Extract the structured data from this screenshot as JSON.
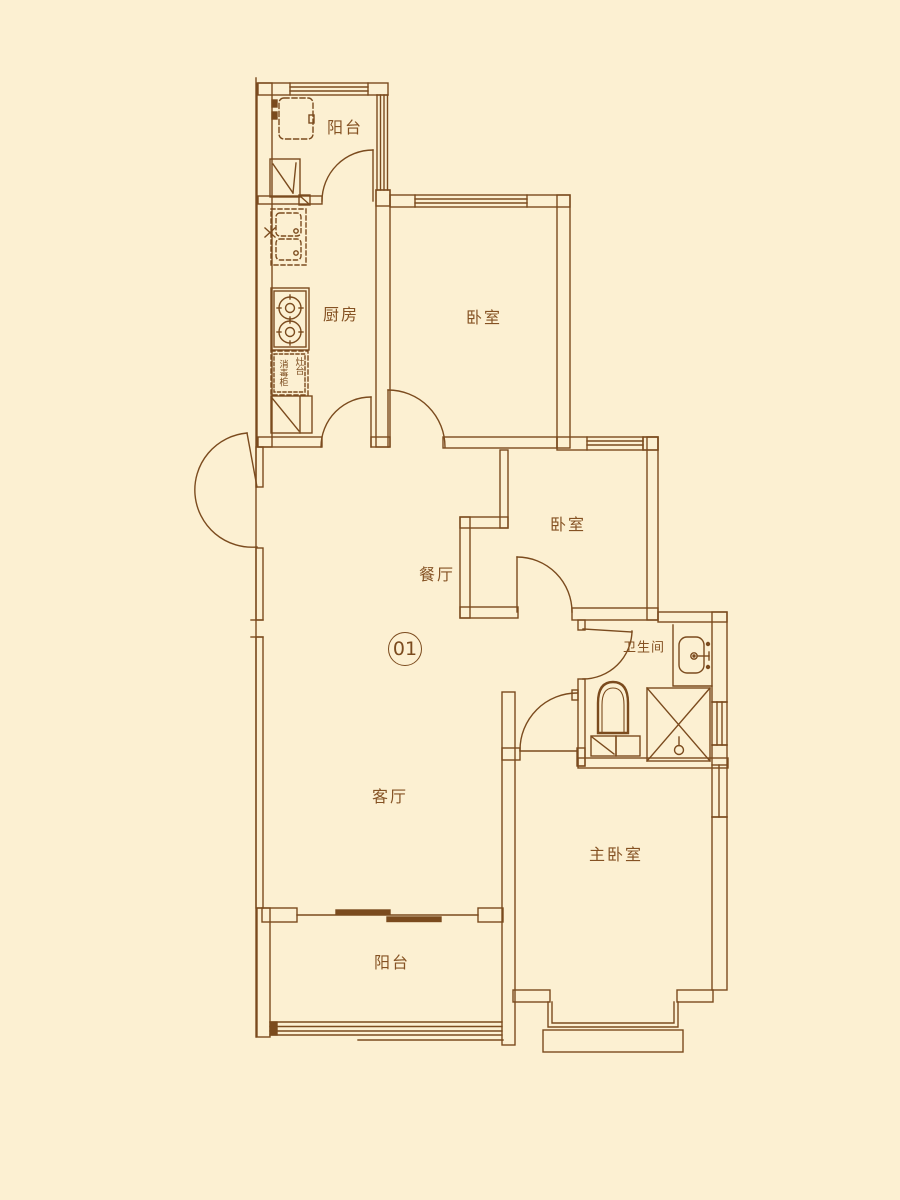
{
  "floorplan": {
    "unit_number": "01",
    "colors": {
      "background": "#fcf0d2",
      "line": "#7b4b1e",
      "text": "#855223"
    },
    "rooms": [
      {
        "id": "balcony-top",
        "label": "阳台"
      },
      {
        "id": "kitchen",
        "label": "厨房"
      },
      {
        "id": "bedroom-north",
        "label": "卧室"
      },
      {
        "id": "bedroom-middle",
        "label": "卧室"
      },
      {
        "id": "dining-room",
        "label": "餐厅"
      },
      {
        "id": "bathroom",
        "label": "卫生间"
      },
      {
        "id": "living-room",
        "label": "客厅"
      },
      {
        "id": "master-bedroom",
        "label": "主卧室"
      },
      {
        "id": "balcony-bottom",
        "label": "阳台"
      }
    ],
    "kitchen_annotations": [
      {
        "id": "cabinet-left",
        "label": "消毒柜"
      },
      {
        "id": "cabinet-right",
        "label": "灶台"
      }
    ]
  }
}
